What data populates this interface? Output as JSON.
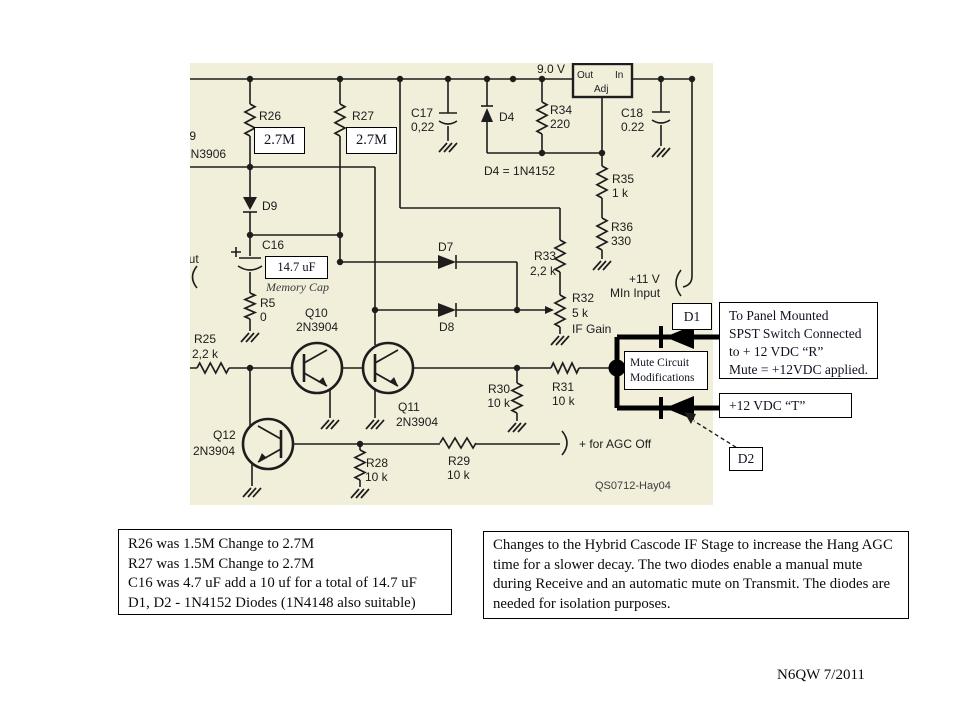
{
  "schematic": {
    "supply_label": "9.0 V",
    "regulator": {
      "out": "Out",
      "in": "In",
      "adj": "Adj"
    },
    "parts": {
      "r26": "R26",
      "r27": "R27",
      "c17": "C17",
      "c17_val": "0,22",
      "d4": "D4",
      "d4_eq": "D4 = 1N4152",
      "r34": "R34",
      "r34_val": "220",
      "c18": "C18",
      "c18_val": "0.22",
      "r35": "R35",
      "r35_val": "1 k",
      "r36": "R36",
      "r36_val": "330",
      "d9": "D9",
      "c16": "C16",
      "c16_note": "Memory Cap",
      "r5": "R5",
      "r5_val": "0",
      "r25": "R25",
      "r25_val": "2,2 k",
      "q10": "Q10",
      "q10_type": "2N3904",
      "q11": "Q11",
      "q11_type": "2N3904",
      "q12": "Q12",
      "q12_type": "2N3904",
      "d7": "D7",
      "d8": "D8",
      "r33": "R33",
      "r33_val": "2,2 k",
      "r32": "R32",
      "r32_val": "5 k",
      "r32_fn": "IF Gain",
      "r30": "R30",
      "r30_val": "10 k",
      "r31": "R31",
      "r31_val": "10 k",
      "r28": "R28",
      "r28_val": "10 k",
      "r29": "R29",
      "r29_val": "10 k"
    },
    "edge_partials": {
      "q9": "Q9",
      "q9_type": "2N3906",
      "input": "Input"
    },
    "misc": {
      "plus11": "+11 V",
      "mln_input": "MIn Input",
      "agc_off": "+ for AGC Off",
      "watermark": "QS0712-Hay04"
    }
  },
  "overlays": {
    "r26_new": "2.7M",
    "r27_new": "2.7M",
    "c16_new": "14.7 uF"
  },
  "annotations": {
    "d1": "D1",
    "d2": "D2",
    "mute_note": "Mute Circuit Modifications",
    "panel_lines": [
      "To Panel Mounted",
      "SPST Switch Connected",
      "to + 12 VDC “R”",
      "Mute = +12VDC applied."
    ],
    "t_label": "+12 VDC “T”"
  },
  "notes": {
    "left_lines": [
      "R26 was 1.5M Change to 2.7M",
      "R27 was 1.5M Change to 2.7M",
      "C16 was 4.7 uF add a 10 uf for a total of 14.7 uF",
      "D1, D2 - 1N4152 Diodes (1N4148 also suitable)"
    ],
    "right_text": "Changes to the Hybrid Cascode IF Stage to increase the Hang AGC time for a slower decay. The two diodes enable a manual mute during Receive and an automatic mute on Transmit. The diodes are needed for isolation purposes."
  },
  "signature": "N6QW 7/2011"
}
